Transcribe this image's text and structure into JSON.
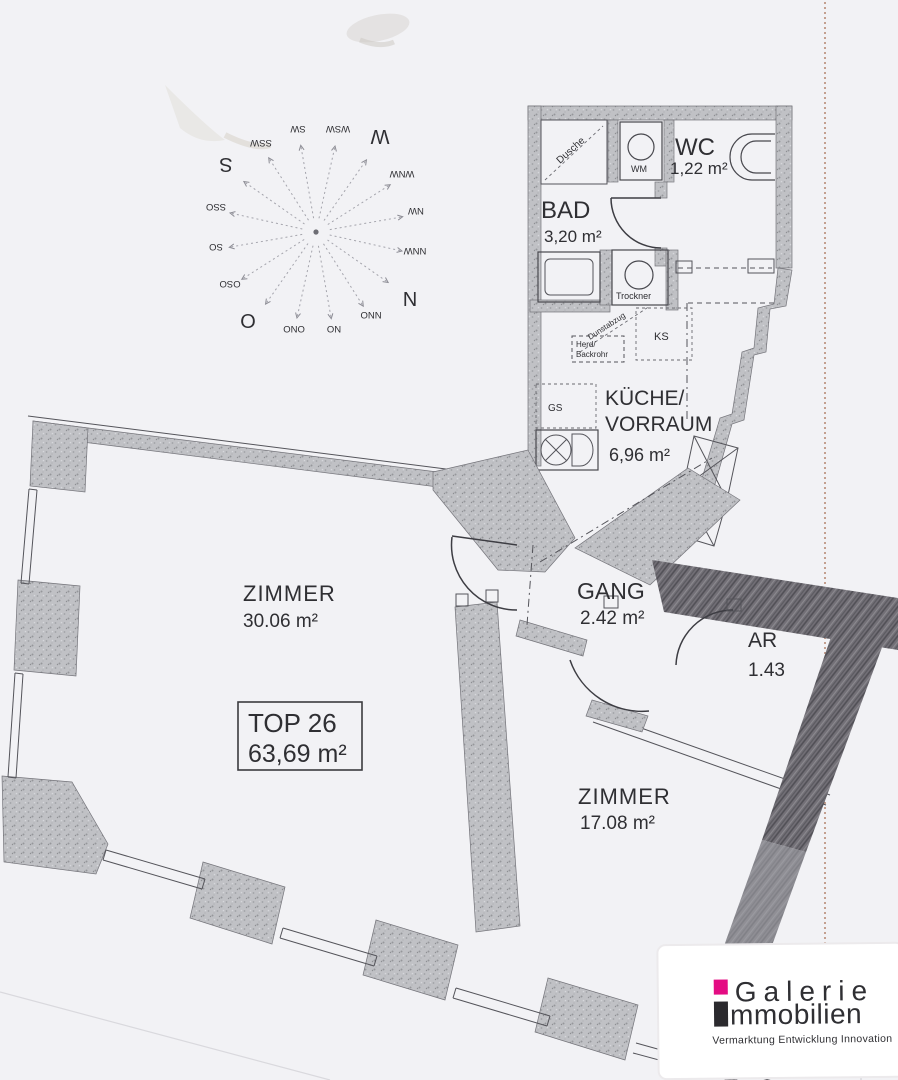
{
  "plan": {
    "unit": {
      "id": "TOP 26",
      "total_area": "63,69 m²"
    },
    "rooms": {
      "wc": {
        "name": "WC",
        "area": "1,22 m²"
      },
      "bad": {
        "name": "BAD",
        "area": "3,20 m²"
      },
      "kueche": {
        "name_line1": "KÜCHE/",
        "name_line2": "VORRAUM",
        "area": "6,96 m²"
      },
      "zimmer_gross": {
        "name": "ZIMMER",
        "area": "30.06 m²"
      },
      "gang": {
        "name": "GANG",
        "area": "2.42 m²"
      },
      "ar": {
        "name": "AR",
        "area": "1.43"
      },
      "zimmer_klein": {
        "name": "ZIMMER",
        "area": "17.08 m²"
      }
    },
    "fixtures": {
      "dusche": "Dusche",
      "wm": "WM",
      "trockner": "Trockner",
      "dunstabzug": "Dunstabzug",
      "herd_line1": "Herd/",
      "herd_line2": "Backrohr",
      "ks": "KS",
      "gs": "GS"
    }
  },
  "compass": {
    "labels": [
      "N",
      "NNO",
      "NO",
      "ONO",
      "O",
      "OSO",
      "SO",
      "SSO",
      "S",
      "SSW",
      "SW",
      "WSW",
      "W",
      "WNW",
      "NW",
      "NNW"
    ]
  },
  "logo": {
    "brand_line1": "Galerie",
    "brand_line2": "mmobilien",
    "tagline": "Vermarktung  Entwicklung  Innovation",
    "accent_color": "#e40c83",
    "text_color": "#3a393d"
  }
}
